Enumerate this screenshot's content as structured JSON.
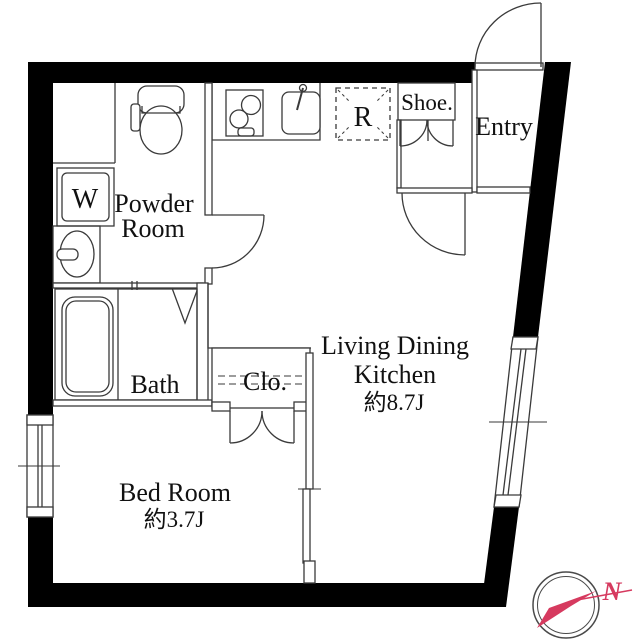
{
  "floorplan": {
    "rooms": {
      "powder_room": {
        "label_line1": "Powder",
        "label_line2": "Room"
      },
      "bath": {
        "label": "Bath"
      },
      "bed_room": {
        "label": "Bed Room",
        "area": "約3.7J"
      },
      "living_dining_kitchen": {
        "label_line1": "Living Dining",
        "label_line2": "Kitchen",
        "area": "約8.7J"
      },
      "closet": {
        "label": "Clo."
      },
      "entry": {
        "label": "Entry"
      },
      "shoe_cabinet": {
        "label": "Shoe."
      },
      "refrigerator_space": {
        "label": "R"
      },
      "washing_machine": {
        "label": "W"
      }
    },
    "compass": {
      "north_label": "N",
      "needle_color": "#d63a5f",
      "ring_color": "#4a4a4a"
    },
    "colors": {
      "wall": "#000000",
      "line": "#3a3a3a",
      "text": "#111111",
      "background": "#ffffff"
    }
  }
}
